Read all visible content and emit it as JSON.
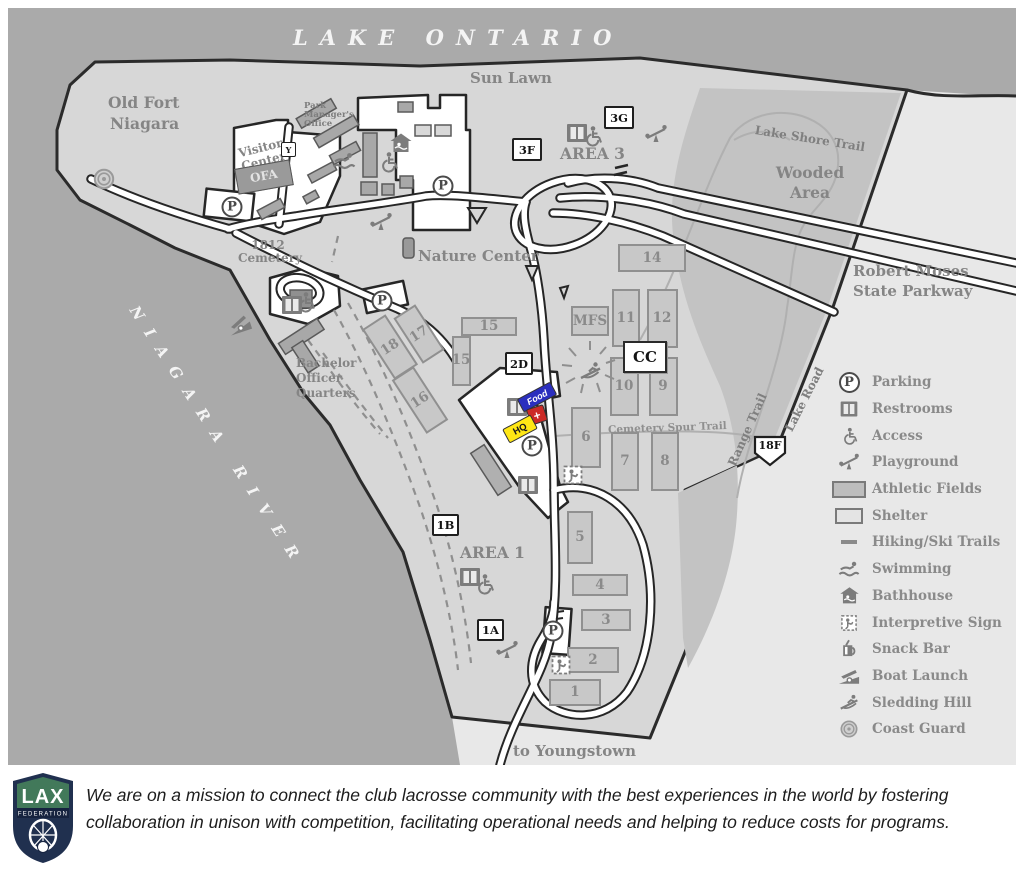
{
  "map": {
    "water": {
      "lake_label": "LAKE  ONTARIO",
      "river_label": "NIAGARA  RIVER"
    },
    "labels": {
      "sun_lawn": "Sun Lawn",
      "old_fort_line1": "Old Fort",
      "old_fort_line2": "Niagara",
      "visitor_center_line1": "Visitor",
      "visitor_center_line2": "Center",
      "ofa": "OFA",
      "park_manager_line1": "Park",
      "park_manager_line2": "Manager's",
      "park_manager_line3": "Office",
      "y_building": "Y",
      "cemetery_line1": "1812",
      "cemetery_line2": "Cemetery",
      "nature_center": "Nature Center",
      "area_3": "AREA 3",
      "area_1": "AREA 1",
      "wooded_line1": "Wooded",
      "wooded_line2": "Area",
      "lake_shore_trail": "Lake Shore Trail",
      "parkway_line1": "Robert Moses",
      "parkway_line2": "State Parkway",
      "boq_line1": "Bachelor",
      "boq_line2": "Officer",
      "boq_line3": "Quarters",
      "cemetery_spur_trail": "Cemetery Spur Trail",
      "range_trail": "Range Trail",
      "lake_road": "Lake Road",
      "to_youngstown": "to Youngstown"
    },
    "markers": {
      "parking_letter": "P",
      "area3_site_f": "3F",
      "area3_site_g": "3G",
      "site_2d": "2D",
      "site_1b": "1B",
      "site_1a": "1A",
      "mfs": "MFS",
      "cc": "CC",
      "route_18f": "18F",
      "food": "Food",
      "hq": "HQ",
      "first_aid": "+"
    },
    "fields": {
      "f1": "1",
      "f2": "2",
      "f3": "3",
      "f4": "4",
      "f5": "5",
      "f6": "6",
      "f7": "7",
      "f8": "8",
      "f9": "9",
      "f10": "10",
      "f11": "11",
      "f12": "12",
      "f14": "14",
      "f15": "15",
      "f16": "16",
      "f17": "17",
      "f18": "18"
    }
  },
  "legend": {
    "items": [
      {
        "icon": "parking-icon",
        "label": "Parking"
      },
      {
        "icon": "restrooms-icon",
        "label": "Restrooms"
      },
      {
        "icon": "access-icon",
        "label": "Access"
      },
      {
        "icon": "playground-icon",
        "label": "Playground"
      },
      {
        "icon": "athletic-fields-swatch",
        "label": "Athletic Fields"
      },
      {
        "icon": "shelter-swatch",
        "label": "Shelter"
      },
      {
        "icon": "hiking-ski-trails-icon",
        "label": "Hiking/Ski Trails"
      },
      {
        "icon": "swimming-icon",
        "label": "Swimming"
      },
      {
        "icon": "bathhouse-icon",
        "label": "Bathhouse"
      },
      {
        "icon": "interpretive-sign-icon",
        "label": "Interpretive Sign"
      },
      {
        "icon": "snack-bar-icon",
        "label": "Snack Bar"
      },
      {
        "icon": "boat-launch-icon",
        "label": "Boat Launch"
      },
      {
        "icon": "sledding-hill-icon",
        "label": "Sledding Hill"
      },
      {
        "icon": "coast-guard-icon",
        "label": "Coast Guard"
      }
    ]
  },
  "footer": {
    "logo_line1": "LAX",
    "logo_line2": "FEDERATION",
    "mission_line1": "We are on a mission to connect the club lacrosse community with the best experiences in the world by fostering",
    "mission_line2": "collaboration in unison with competition, facilitating operational needs and helping to reduce costs for programs."
  },
  "colors": {
    "water": "#aaaaaa",
    "park_land": "#d7d7d7",
    "outside_park": "#e8e8e8",
    "wooded": "#c3c3c3",
    "road": "#ffffff",
    "outline": "#2b2b2b",
    "label_gray": "#8a8a8a",
    "food_blue": "#2b2fbe",
    "hq_yellow": "#ffe715",
    "first_aid_red": "#cc2a26",
    "logo_navy": "#20304f",
    "logo_green": "#42795a"
  }
}
